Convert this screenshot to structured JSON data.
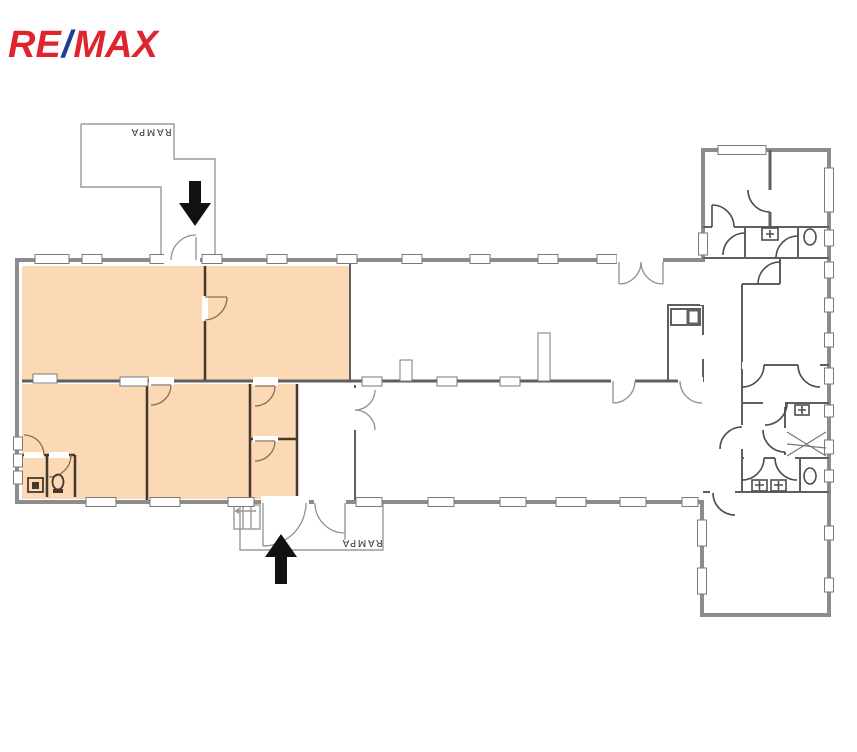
{
  "brand": {
    "re": "RE",
    "slash": "/",
    "max": "MAX"
  },
  "ramp_labels": {
    "top": "RAMPA",
    "bottom": "RAMPA"
  },
  "colors": {
    "highlight": "#FBD9B4",
    "brand_red": "#E0242D",
    "brand_blue": "#1C3E93",
    "wall": "#8C8C8C",
    "wall_mid": "#5F5F5F",
    "wall_dark": "#45392C",
    "door_arc": "#8A6F4E",
    "door_gray": "#909090",
    "ink": "#111111",
    "label": "#3C3C3C"
  },
  "icons": {
    "entrance_arrow_top": "arrow-down",
    "entrance_arrow_bottom": "arrow-up",
    "toilet": "oval-wc",
    "sink": "square-basin",
    "steps": "steps-with-arrow",
    "stairs_cross": "diagonal-hatch"
  }
}
